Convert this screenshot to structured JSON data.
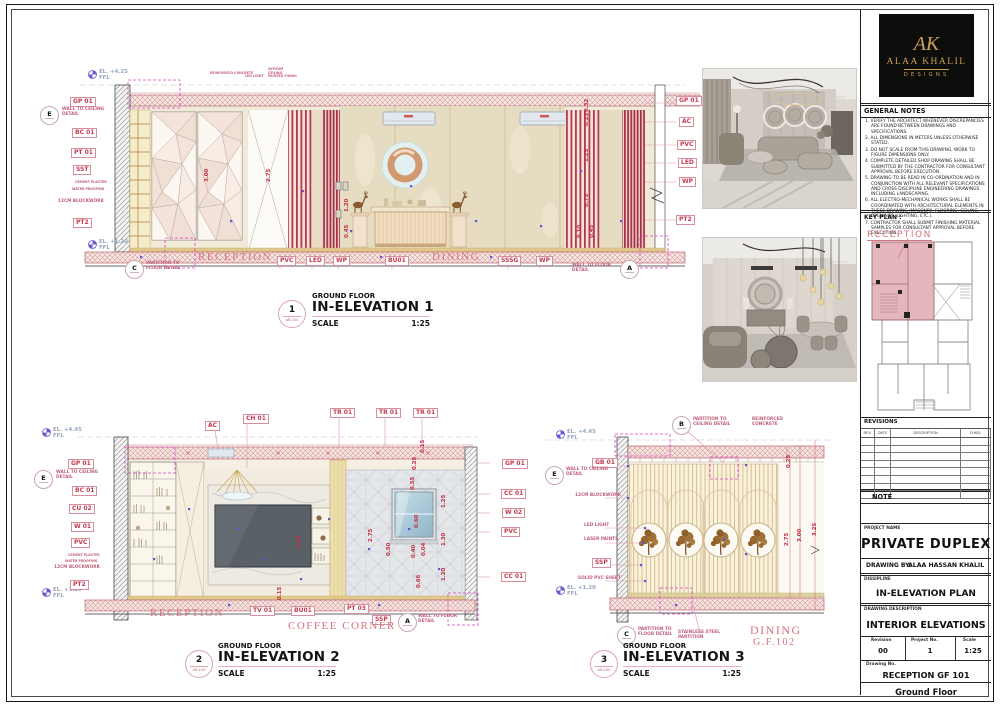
{
  "colors": {
    "accent_pink": "#c23a4e",
    "magenta_dashed": "#e040c0",
    "blue_marker": "#6152d8",
    "gold": "#c8a85a",
    "panel_black": "#0d0d0c",
    "logo_gold": "#c9a05a"
  },
  "logo": {
    "monogram": "AK",
    "name": "ALAA KHALIL",
    "sub": "DESIGNS"
  },
  "notes": {
    "title": "GENERAL NOTES",
    "items": [
      "1. VERIFY THE ARCHITECT WHENEVER DISCREPANCIES ARE FOUND BETWEEN DRAWINGS AND SPECIFICATIONS.",
      "2. ALL DIMENSIONS IN METERS UNLESS OTHERWISE STATED.",
      "3. DO NOT SCALE FROM THIS DRAWING, WORK TO FIGURE DIMENSIONS ONLY.",
      "4. COMPLETE DETAILED SHOP DRAWING SHALL BE SUBMITTED BY THE CONTRACTOR FOR CONSULTANT APPROVAL BEFORE EXECUTION.",
      "5. DRAWING TO BE READ IN CO-ORDINATION AND IN CONJUNCTION WITH ALL RELEVANT SPECIFICATIONS AND CROSS DISCIPLINE ENGINEERING DRAWINGS INCLUDING LANDSCAPING.",
      "6. ALL ELECTRO-MECHANICAL WORKS SHALL BE COORDINATED WITH ARCHITECTURAL ELEMENTS IN THESE DRAWING (MASONRY, FLOORING, CEILING, OPENINGS, LIGHTING, ETC.).",
      "7. CONTRACTOR SHALL SUBMIT FINISHING MATERIAL SAMPLES FOR CONSULTANT APPROVAL BEFORE EXECUTION."
    ]
  },
  "key_plan": {
    "title": "KEY PLAN :",
    "room": "RECEPTION"
  },
  "revisions": {
    "title": "REVISIONS",
    "headers": [
      "REV.",
      "DATE",
      "DESCRIPTION",
      "CHKD."
    ]
  },
  "titleblock": {
    "note": "NOTE",
    "project_label": "PROJECT NAME",
    "project": "PRIVATE DUPLEX",
    "by_label": "DRAWING BY:",
    "by": "ALAA HASSAN KHALIL",
    "discipline_label": "DISSIPLINE",
    "discipline": "IN-ELEVATION PLAN",
    "desc_label": "DRAWING DESCRIPTION",
    "desc": "INTERIOR ELEVATIONS",
    "rev_label": "Revision",
    "rev": "00",
    "proj_no_label": "Project No.",
    "proj_no": "1",
    "scale_label": "Scale",
    "scale": "1:25",
    "dwg_no_label": "Drawing No.",
    "dwg_no": "RECEPTION  GF 101",
    "floor": "Ground Floor"
  },
  "elev1": {
    "title": {
      "num": "1",
      "ref": "AR-100",
      "floor": "GROUND FLOOR",
      "name": "IN-ELEVATION 1",
      "scale_label": "SCALE",
      "scale": "1:25"
    },
    "lvl_top": "EL. +4.25",
    "lvl_bot": "EL. +1.20",
    "ffl": "FFL",
    "tags_left": [
      "GP 01",
      "BC 01",
      "PT 01",
      "SST",
      "PT2"
    ],
    "tiny_left": [
      "CEMENT PLASTER",
      "WATER PROOFING",
      "12CM BLOCKWORK"
    ],
    "top_notes": [
      "REINFORCED CONCRETE",
      "LED LIGHT",
      "GYPSUM CEILING PAINTED FINISH"
    ],
    "det_e_letter": "E",
    "det_e": "WALL TO CEILING DETAIL",
    "det_c_letter": "C",
    "det_c": "PARTITION TO FLOOR DETAIL",
    "det_a_letter": "A",
    "det_a": "WALL TO FLOOR DETAIL",
    "tags_right": [
      "GP 01",
      "AC",
      "PVC",
      "LED",
      "WP",
      "PT2"
    ],
    "rooms": [
      "RECEPTION",
      "DINING"
    ],
    "tags_bottom": [
      "PVC",
      "LED",
      "WP",
      "BU01",
      "SSSG",
      "WP"
    ],
    "dims": [
      "3.00",
      "2.75",
      "1.20",
      "0.45",
      "0.32",
      "0.25",
      "1.25",
      "0.75",
      "0.10",
      "0.45"
    ]
  },
  "elev2": {
    "title": {
      "num": "2",
      "ref": "AR-100",
      "floor": "GROUND FLOOR",
      "name": "IN-ELEVATION 2",
      "scale_label": "SCALE",
      "scale": "1:25"
    },
    "lvl_top": "EL. +4.45",
    "lvl_bot": "EL. +1.20",
    "ffl": "FFL",
    "top_tags": [
      "AC",
      "CH 01",
      "TR 01",
      "TR 01",
      "TR 01"
    ],
    "tags_left": [
      "GP 01",
      "BC 01",
      "CU 02",
      "W 01",
      "PVC",
      "PT2"
    ],
    "tiny_left": [
      "CEMENT PLASTER",
      "WATER PROOFING",
      "12CM BLOCKWORK"
    ],
    "det_e_letter": "E",
    "det_e": "WALL TO CEILING DETAIL",
    "det_a_letter": "A",
    "det_a": "WALL TO FLOOR DETAIL",
    "tags_right": [
      "GP 01",
      "CC 01",
      "W 02",
      "PVC",
      "CC 01"
    ],
    "rooms": [
      "RECEPTION",
      "COFFEE CORNER"
    ],
    "tags_bottom": [
      "TV 01",
      "BU01",
      "PT 03",
      "SSP"
    ],
    "dims": [
      "0.15",
      "0.25",
      "0.55",
      "1.25",
      "0.60",
      "1.30",
      "0.50",
      "0.40",
      "0.04",
      "1.20",
      "0.66",
      "2.75",
      "1.61",
      "0.15"
    ]
  },
  "elev3": {
    "title": {
      "num": "3",
      "ref": "AR-100",
      "floor": "GROUND FLOOR",
      "name": "IN-ELEVATION 3",
      "scale_label": "SCALE",
      "scale": "1:25"
    },
    "lvl_top": "EL. +4.45",
    "lvl_bot": "EL. +1.20",
    "ffl": "FFL",
    "det_b_letter": "B",
    "det_b": "PARTITION TO CEILING DETAIL",
    "reinforced": "REINFORCED CONCRETE",
    "gb": "GB 01",
    "ssp": "SSP",
    "det_e_letter": "E",
    "det_e": "WALL TO CEILING DETAIL",
    "det_c_letter": "C",
    "det_c": "PARTITION TO FLOOR DETAIL",
    "tiny_left": [
      "12CM BLOCKWORK",
      "LED LIGHT",
      "LASER PAINTS",
      "SOLID PVC SHEET"
    ],
    "ss_partition": "STAINLESS STEEL PARTITION",
    "room": "DINING",
    "room_no": "G.F.102",
    "dims": [
      "0.25",
      "2.75",
      "3.00",
      "3.25"
    ]
  }
}
